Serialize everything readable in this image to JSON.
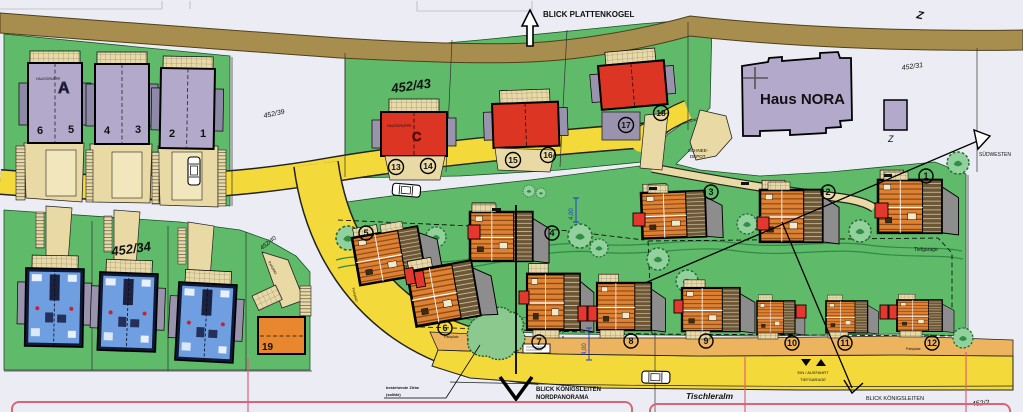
{
  "map": {
    "compass": {
      "blick_plattenkogel": "BLICK PLATTENKOGEL",
      "suedwesten": "SÜDWESTEN",
      "blick_koenigsleiten_nord": "BLICK KÖNIGSLEITEN",
      "nordpanorama": "NORDPANORAMA",
      "blick_koenigsleiten_sued": "BLICK KÖNIGSLEITEN"
    },
    "streets": {
      "tischleralm": "Tischleralm"
    },
    "parcels": {
      "p452_39": "452/39",
      "p452_43": "452/43",
      "p452_31": "452/31",
      "p452_34": "452/34",
      "p452_40": "452/40",
      "p452_2": "452/2"
    },
    "buildings": {
      "haus_nora": "Haus NORA",
      "hausgruppe_label": "HAUSGRUPPE",
      "group_a_letter": "A",
      "group_c_letter": "C",
      "house_19": "19",
      "z_mark": "Z"
    },
    "annotations": {
      "schnee_depot_line1": "SCHNEE-",
      "schnee_depot_line2": "DEPOT",
      "tiefgarage": "Tiefgarage",
      "ein_ausfahrt": "EIN / AUSFAHRT",
      "tiefgarage_caps": "TIEFGARAGE",
      "zirbe_line1": "bestehende Zirbe",
      "zirbe_line2": "(solitär)",
      "parkplatz": "Parkplatz",
      "dim_4m": "4,00"
    },
    "units_a": [
      "6",
      "5",
      "4",
      "3",
      "2",
      "1"
    ],
    "units_c": [
      "13",
      "14",
      "15",
      "16",
      "17",
      "18"
    ],
    "units_chalets": [
      "1",
      "2",
      "3",
      "4",
      "5",
      "6",
      "7",
      "8",
      "9",
      "10",
      "11",
      "12"
    ]
  },
  "colors": {
    "background": "#ecedf4",
    "meadow_green": "#5fba6a",
    "road_yellow": "#f4d93b",
    "upper_road_brown": "#a78e4e",
    "house_red": "#dd3524",
    "house_purple": "#b3aacb",
    "chalet_orange": "#dd8133",
    "house_blue": "#6f9fe0",
    "terrace_tan": "#e9d9a4",
    "parking_orange": "#edb45f",
    "boundary_pink": "#e0607a",
    "dimension_blue": "#2038c8"
  }
}
